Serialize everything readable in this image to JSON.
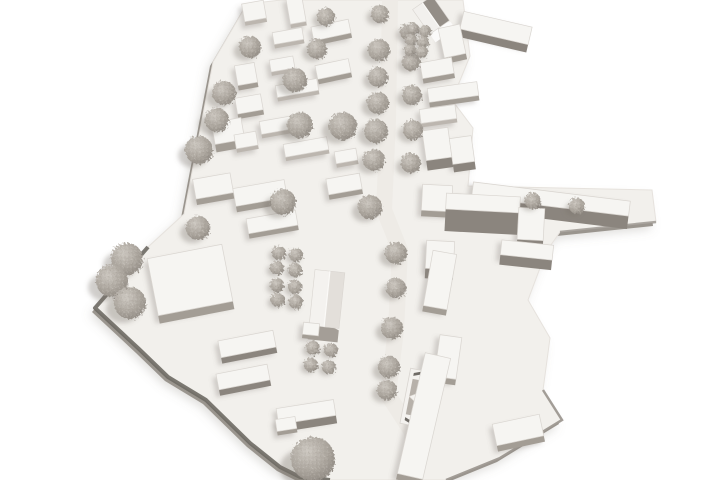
{
  "meta": {
    "description": "Aerial photograph of a white architectural massing model: an elongated urban district on an irregular white base plate, with rows of slab buildings flanking a central tree-lined street, a gabled house at the top, a gabled barn-like church in the lower middle, a star-roofed pavilion near the bottom, and many fuzzy gray foam trees."
  },
  "scene": {
    "background": "#ffffff",
    "palette": {
      "plate": "#f2f0ec",
      "plate_stroke": "#e6e2dd",
      "plate_rim_dark": "#6e6a64",
      "plate_rim_light": "#9a958e",
      "plate_shadow": "rgba(125,119,111,0.25)",
      "street": "#edeae5",
      "roof_top": "#f6f5f2",
      "roof_stroke": "#d9d5d0",
      "faces": [
        "#bcb6af",
        "#a39d95",
        "#8b857e"
      ],
      "building_shadow": "rgba(125,119,111,0.30)",
      "tree_core": "#cdc8c1",
      "tree_mid": "#aaa49c",
      "tree_edge": "#8f8982",
      "tree_shadow": "rgba(120,114,106,0.35)",
      "star_dark": "#6f6b66",
      "star_gray": "#b7b1aa",
      "star_white": "#f4f2ef"
    },
    "base_outline": [
      [
        281,
        0
      ],
      [
        463,
        0
      ],
      [
        470,
        56
      ],
      [
        452,
        100
      ],
      [
        473,
        128
      ],
      [
        468,
        186
      ],
      [
        652,
        190
      ],
      [
        656,
        222
      ],
      [
        560,
        232
      ],
      [
        546,
        252
      ],
      [
        528,
        300
      ],
      [
        550,
        338
      ],
      [
        543,
        390
      ],
      [
        562,
        420
      ],
      [
        500,
        458
      ],
      [
        446,
        480
      ],
      [
        330,
        480
      ],
      [
        300,
        477
      ],
      [
        280,
        467
      ],
      [
        250,
        443
      ],
      [
        206,
        400
      ],
      [
        168,
        377
      ],
      [
        139,
        349
      ],
      [
        95,
        308
      ],
      [
        148,
        247
      ],
      [
        184,
        214
      ],
      [
        213,
        62
      ],
      [
        247,
        4
      ]
    ],
    "rim_dark": [
      [
        148,
        247
      ],
      [
        95,
        308
      ],
      [
        139,
        349
      ],
      [
        168,
        377
      ],
      [
        206,
        400
      ],
      [
        250,
        443
      ],
      [
        280,
        467
      ],
      [
        300,
        477
      ],
      [
        330,
        480
      ]
    ],
    "rim_right": [
      [
        543,
        390
      ],
      [
        562,
        420
      ],
      [
        500,
        458
      ],
      [
        446,
        480
      ]
    ],
    "rim_wing": [
      [
        656,
        222
      ],
      [
        560,
        232
      ]
    ],
    "street_path": [
      [
        390,
        0
      ],
      [
        388,
        120
      ],
      [
        384,
        210
      ],
      [
        400,
        250
      ],
      [
        396,
        330
      ],
      [
        388,
        395
      ],
      [
        412,
        432
      ],
      [
        415,
        480
      ]
    ],
    "boxes": [
      [
        254,
        11,
        22,
        18,
        -10,
        4,
        0
      ],
      [
        296,
        10,
        16,
        26,
        -10,
        4,
        0
      ],
      [
        331,
        30,
        38,
        14,
        -12,
        5,
        1
      ],
      [
        288,
        36,
        30,
        12,
        -10,
        4,
        0
      ],
      [
        282,
        64,
        24,
        12,
        -10,
        4,
        0
      ],
      [
        333,
        69,
        34,
        14,
        -12,
        5,
        1
      ],
      [
        246,
        74,
        20,
        20,
        -10,
        5,
        1
      ],
      [
        297,
        88,
        42,
        12,
        -10,
        4,
        0
      ],
      [
        249,
        104,
        26,
        16,
        -10,
        5,
        1
      ],
      [
        283,
        124,
        46,
        13,
        -10,
        4,
        0
      ],
      [
        246,
        140,
        22,
        14,
        -10,
        4,
        0
      ],
      [
        306,
        147,
        44,
        13,
        -10,
        4,
        0
      ],
      [
        346,
        156,
        22,
        12,
        -10,
        4,
        0
      ],
      [
        228,
        131,
        30,
        22,
        -10,
        8,
        1
      ],
      [
        213,
        186,
        38,
        20,
        -10,
        6,
        1
      ],
      [
        260,
        193,
        52,
        18,
        -10,
        6,
        1
      ],
      [
        344,
        184,
        34,
        16,
        -10,
        5,
        1
      ],
      [
        272,
        222,
        50,
        15,
        -10,
        5,
        1
      ],
      [
        190,
        280,
        76,
        58,
        -11,
        8,
        1
      ],
      [
        247,
        344,
        56,
        17,
        -11,
        6,
        2
      ],
      [
        243,
        377,
        52,
        16,
        -11,
        6,
        2
      ],
      [
        306,
        412,
        58,
        16,
        -9,
        8,
        2
      ],
      [
        286,
        424,
        20,
        12,
        -9,
        4,
        1
      ],
      [
        452,
        41,
        22,
        30,
        -12,
        6,
        1
      ],
      [
        496,
        28,
        70,
        18,
        13,
        8,
        2
      ],
      [
        437,
        68,
        32,
        16,
        -10,
        5,
        1
      ],
      [
        453,
        92,
        50,
        14,
        -8,
        5,
        1
      ],
      [
        438,
        114,
        36,
        14,
        -8,
        4,
        0
      ],
      [
        437,
        144,
        26,
        30,
        -8,
        10,
        2
      ],
      [
        462,
        150,
        22,
        26,
        -8,
        8,
        2
      ],
      [
        437,
        198,
        30,
        26,
        3,
        6,
        1
      ],
      [
        483,
        203,
        74,
        16,
        3,
        22,
        2
      ],
      [
        531,
        224,
        26,
        32,
        3,
        14,
        2
      ],
      [
        440,
        255,
        28,
        28,
        3,
        10,
        2
      ],
      [
        551,
        199,
        158,
        15,
        7,
        13,
        2
      ],
      [
        527,
        250,
        52,
        15,
        6,
        10,
        2
      ],
      [
        440,
        280,
        24,
        56,
        10,
        6,
        1
      ],
      [
        448,
        357,
        22,
        42,
        8,
        6,
        1
      ],
      [
        424,
        416,
        26,
        124,
        13,
        6,
        1
      ],
      [
        518,
        430,
        48,
        22,
        -12,
        6,
        1
      ],
      [
        311,
        329,
        16,
        12,
        6,
        4,
        1
      ]
    ],
    "gables": [
      {
        "x": 431,
        "y": 15,
        "w": 24,
        "h": 30,
        "rot": -35,
        "planeL": "#f2f0ed",
        "planeR": "#948e87",
        "gable": "#fbfaf9",
        "gableDepth": 10
      },
      {
        "x": 327,
        "y": 299,
        "w": 30,
        "h": 56,
        "rot": 6,
        "planeL": "#f4f2ef",
        "planeR": "#e3dfda",
        "gable": "#a49e97",
        "gableDepth": 14
      }
    ],
    "star": {
      "x": 422,
      "y": 399,
      "w": 34,
      "h": 56,
      "rot": 11
    },
    "trees": [
      [
        380,
        14,
        9
      ],
      [
        379,
        50,
        11
      ],
      [
        378,
        77,
        10
      ],
      [
        378,
        103,
        11
      ],
      [
        376,
        131,
        12
      ],
      [
        374,
        160,
        11
      ],
      [
        370,
        207,
        12
      ],
      [
        396,
        253,
        11
      ],
      [
        396,
        288,
        10
      ],
      [
        392,
        328,
        11
      ],
      [
        389,
        367,
        11
      ],
      [
        387,
        390,
        10
      ],
      [
        408,
        32,
        8
      ],
      [
        411,
        62,
        9
      ],
      [
        412,
        95,
        10
      ],
      [
        413,
        130,
        10
      ],
      [
        411,
        163,
        10
      ],
      [
        326,
        17,
        9
      ],
      [
        250,
        47,
        11
      ],
      [
        317,
        49,
        10
      ],
      [
        295,
        80,
        12
      ],
      [
        224,
        93,
        12
      ],
      [
        217,
        120,
        12
      ],
      [
        300,
        125,
        13
      ],
      [
        343,
        126,
        14
      ],
      [
        199,
        150,
        14
      ],
      [
        283,
        202,
        13
      ],
      [
        198,
        228,
        12
      ],
      [
        127,
        259,
        16
      ],
      [
        112,
        281,
        16
      ],
      [
        130,
        303,
        16
      ],
      [
        413,
        29,
        6
      ],
      [
        425,
        31,
        6
      ],
      [
        411,
        40,
        6
      ],
      [
        423,
        42,
        6
      ],
      [
        410,
        50,
        6
      ],
      [
        422,
        52,
        6
      ],
      [
        279,
        253,
        7
      ],
      [
        296,
        255,
        7
      ],
      [
        277,
        268,
        7
      ],
      [
        295,
        270,
        7
      ],
      [
        277,
        285,
        7
      ],
      [
        295,
        287,
        7
      ],
      [
        278,
        300,
        7
      ],
      [
        296,
        302,
        7
      ],
      [
        313,
        348,
        7
      ],
      [
        331,
        350,
        7
      ],
      [
        311,
        365,
        7
      ],
      [
        329,
        367,
        7
      ],
      [
        533,
        201,
        8
      ],
      [
        577,
        206,
        8
      ],
      [
        313,
        459,
        22
      ]
    ]
  }
}
